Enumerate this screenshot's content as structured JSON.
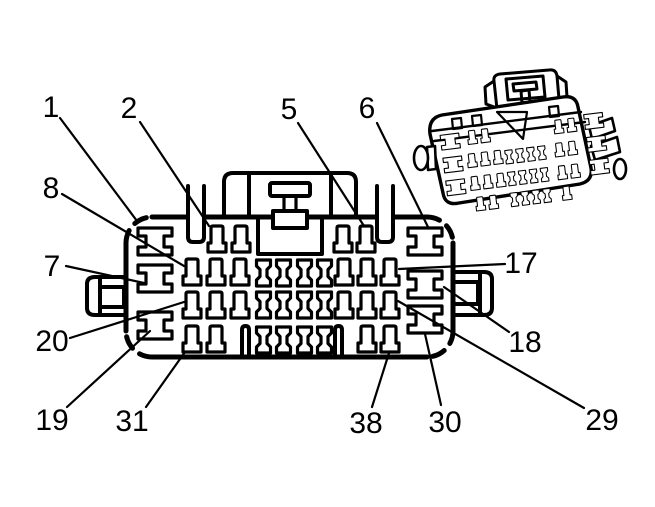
{
  "diagram": {
    "title": "connector-pinout-diagram",
    "colors": {
      "line": "#000000",
      "background": "#ffffff"
    },
    "callouts": [
      {
        "label": "1"
      },
      {
        "label": "2"
      },
      {
        "label": "5"
      },
      {
        "label": "6"
      },
      {
        "label": "8"
      },
      {
        "label": "7"
      },
      {
        "label": "17"
      },
      {
        "label": "18"
      },
      {
        "label": "20"
      },
      {
        "label": "19"
      },
      {
        "label": "31"
      },
      {
        "label": "38"
      },
      {
        "label": "30"
      },
      {
        "label": "29"
      }
    ]
  }
}
